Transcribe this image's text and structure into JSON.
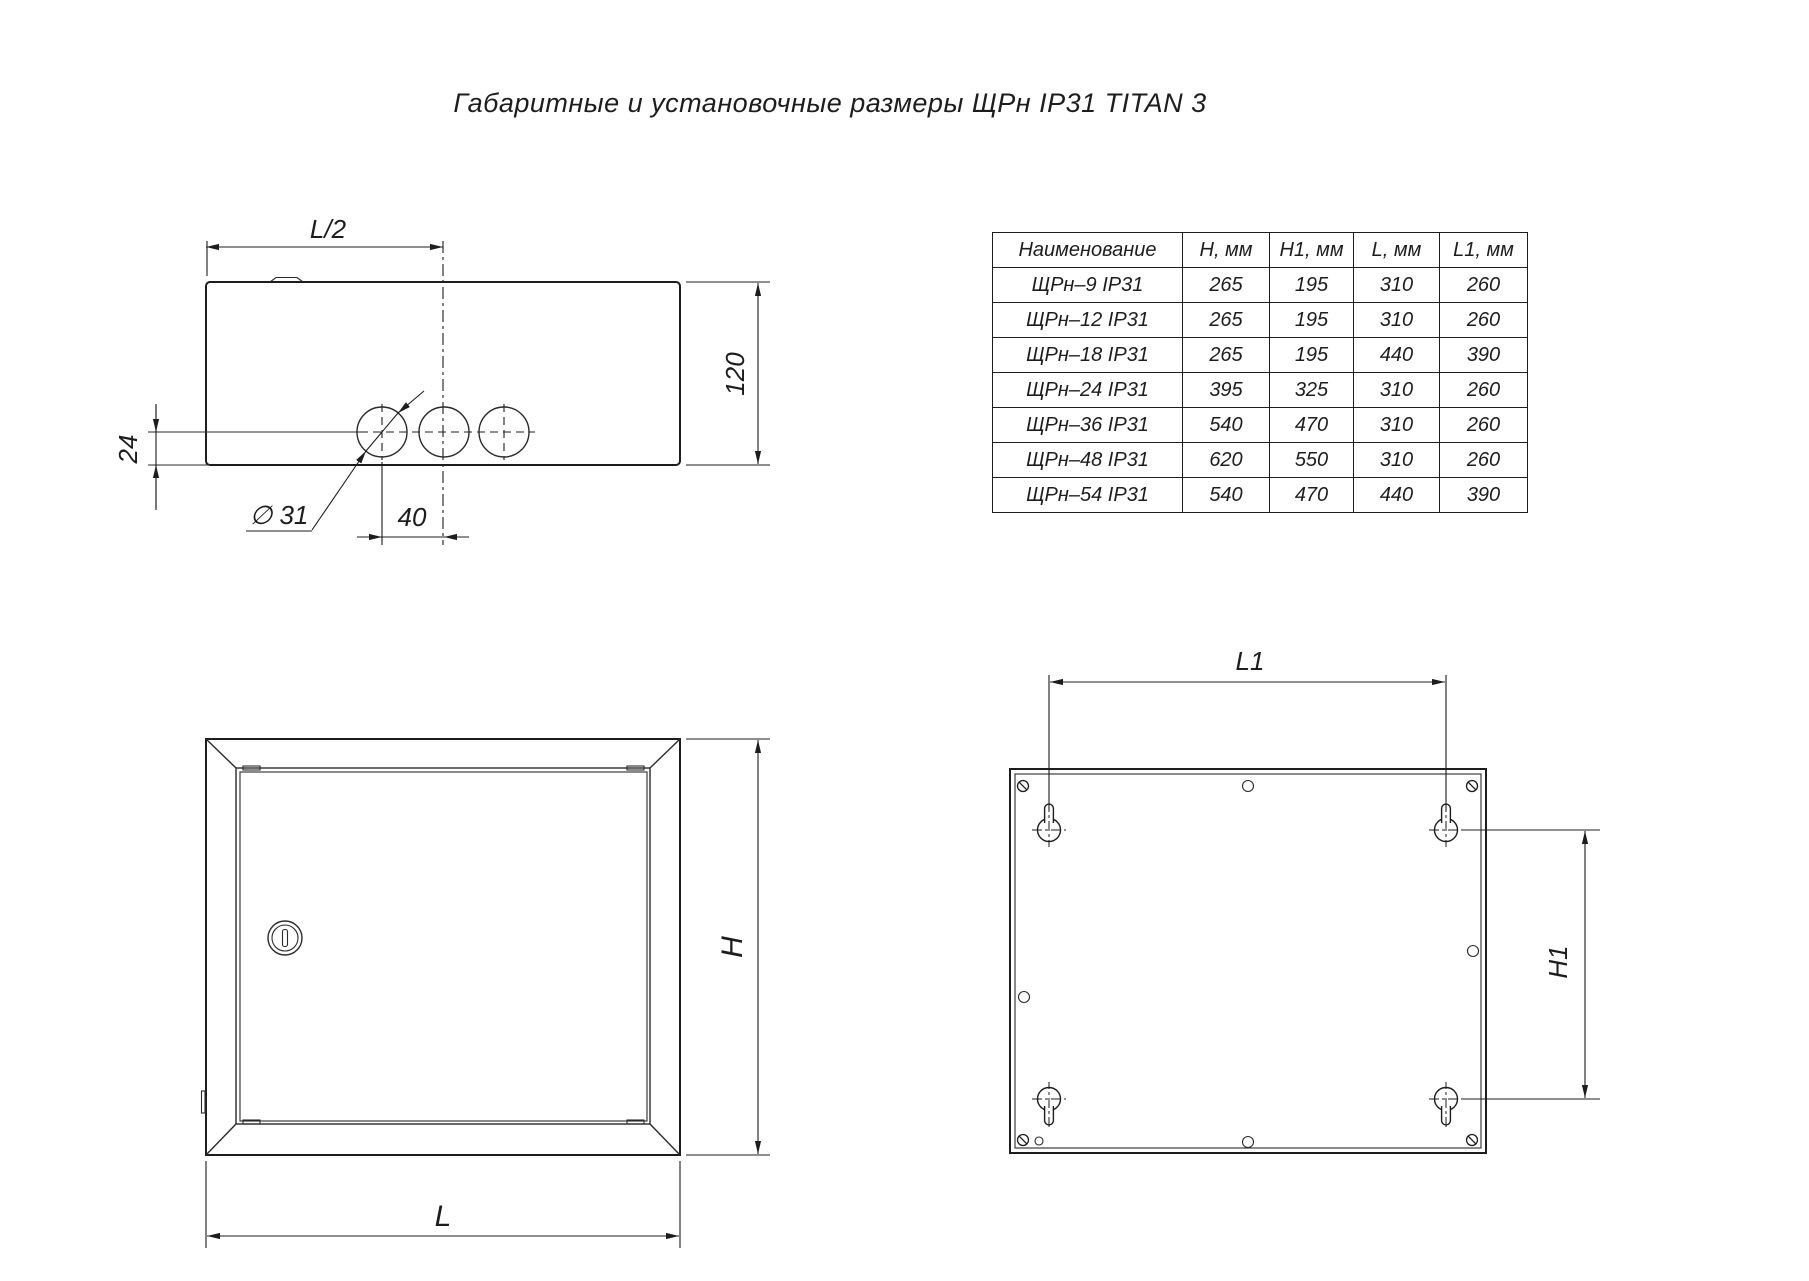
{
  "title": "Габаритные и установочные размеры ЩРн IP31 TITAN 3",
  "table": {
    "headers": [
      "Наименование",
      "H, мм",
      "H1, мм",
      "L, мм",
      "L1, мм"
    ],
    "rows": [
      {
        "name": "ЩРн–9 IP31",
        "h": "265",
        "h1": "195",
        "l": "310",
        "l1": "260"
      },
      {
        "name": "ЩРн–12 IP31",
        "h": "265",
        "h1": "195",
        "l": "310",
        "l1": "260"
      },
      {
        "name": "ЩРн–18 IP31",
        "h": "265",
        "h1": "195",
        "l": "440",
        "l1": "390"
      },
      {
        "name": "ЩРн–24 IP31",
        "h": "395",
        "h1": "325",
        "l": "310",
        "l1": "260"
      },
      {
        "name": "ЩРн–36 IP31",
        "h": "540",
        "h1": "470",
        "l": "310",
        "l1": "260"
      },
      {
        "name": "ЩРн–48 IP31",
        "h": "620",
        "h1": "550",
        "l": "310",
        "l1": "260"
      },
      {
        "name": "ЩРн–54 IP31",
        "h": "540",
        "h1": "470",
        "l": "440",
        "l1": "390"
      }
    ]
  },
  "dimensions": {
    "top_view": {
      "half_width": "L/2",
      "depth": "120",
      "hole_offset": "24",
      "hole_diameter": "∅ 31",
      "hole_spacing": "40"
    },
    "front_view": {
      "width": "L",
      "height": "H"
    },
    "back_view": {
      "mount_width": "L1",
      "mount_height": "H1"
    }
  },
  "colors": {
    "line": "#1d1d1d",
    "background": "#ffffff"
  }
}
